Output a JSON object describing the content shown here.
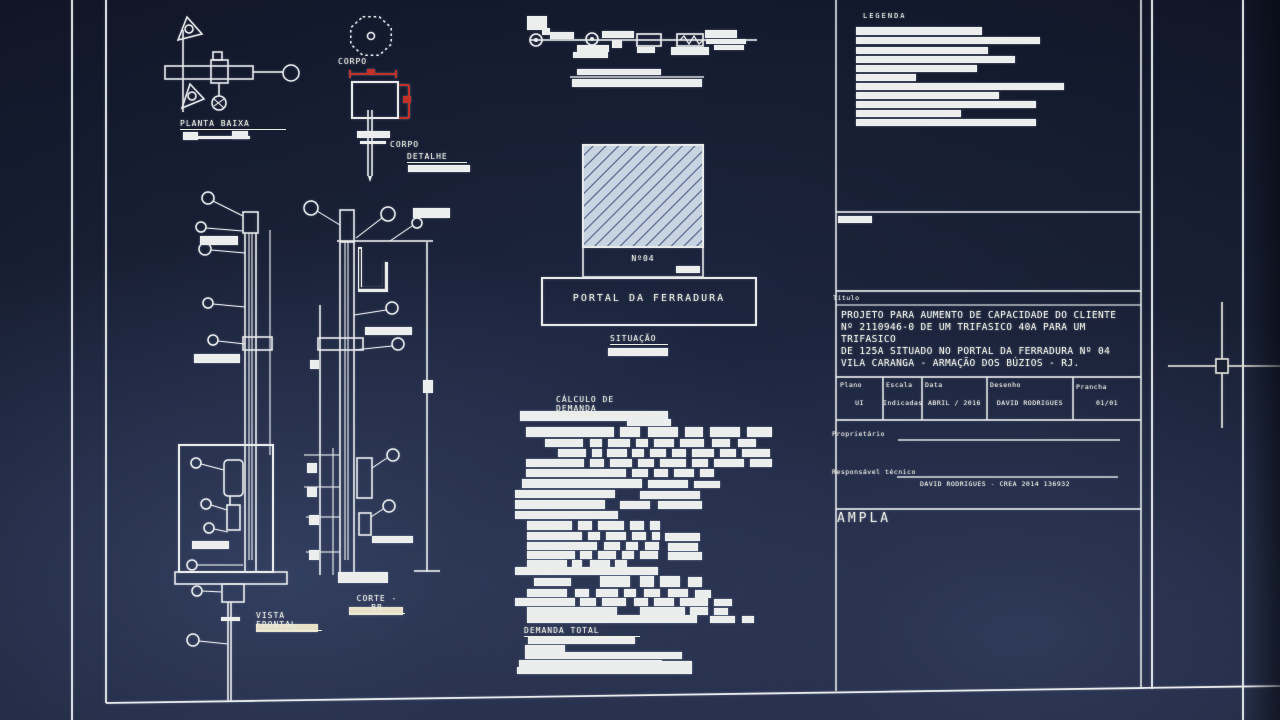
{
  "colors": {
    "line": "#e8eae9",
    "red_dimension": "#c23128",
    "sheet_background": "#161c2d",
    "hatch_fill": "#c9d4e2",
    "hatch_stripe": "#55658a",
    "label_bar_tan": "#e8e1c8"
  },
  "drawings": {
    "planta_baixa_label": "PLANTA BAIXA",
    "corpo_octagon_label": "CORPO",
    "corpo_detail_label": "CORPO",
    "detalhe_label": "DETALHE",
    "situacao_label": "SITUAÇÃO",
    "poste_numero": "Nº04",
    "portal_label": "PORTAL DA FERRADURA",
    "calculo_demanda_label": "CÁLCULO DE DEMANDA",
    "demanda_total_label": "DEMANDA TOTAL",
    "vista_frontal_label": "VISTA FRONTAL",
    "corte_bb_label": "CORTE - BB"
  },
  "title_block": {
    "legenda_label": "LEGENDA",
    "titulo_label": "Título",
    "titulo_text": "PROJETO PARA AUMENTO DE CAPACIDADE DO CLIENTE\nNº 2110946-0 DE UM TRIFASICO 40A PARA UM TRIFASICO\nDE 125A SITUADO NO PORTAL DA FERRADURA Nº 04\nVILA CARANGA - ARMAÇÃO DOS BÚZIOS - RJ.",
    "fields": [
      {
        "label": "Plano",
        "value": "UI"
      },
      {
        "label": "Escala",
        "value": "Indicadas"
      },
      {
        "label": "Data",
        "value": "ABRIL / 2016"
      },
      {
        "label": "Desenho",
        "value": "DAVID RODRIGUES"
      },
      {
        "label": "Prancha",
        "value": "01/01"
      }
    ],
    "proprietario_label": "Proprietário",
    "responsavel_label": "Responsável técnico",
    "responsavel_value": "DAVID RODRIGUES - CREA 2014 136932",
    "company": "AMPLA"
  },
  "redacted": {
    "legend": [
      [
        856,
        27,
        126,
        8
      ],
      [
        856,
        37,
        184,
        7
      ],
      [
        856,
        47,
        132,
        7
      ],
      [
        856,
        56,
        159,
        7
      ],
      [
        856,
        65,
        121,
        7
      ],
      [
        856,
        74,
        60,
        7
      ],
      [
        856,
        83,
        208,
        7
      ],
      [
        856,
        92,
        143,
        7
      ],
      [
        856,
        101,
        180,
        7
      ],
      [
        856,
        110,
        105,
        7
      ],
      [
        856,
        119,
        180,
        7
      ],
      [
        838,
        216,
        34,
        7
      ]
    ],
    "diagram_caption": [
      [
        577,
        69,
        84,
        6
      ],
      [
        572,
        79,
        130,
        8
      ]
    ],
    "demand_table": [
      [
        520,
        411,
        148,
        10
      ],
      [
        627,
        419,
        44,
        7
      ],
      [
        526,
        427,
        88,
        10
      ],
      [
        620,
        427,
        20,
        10
      ],
      [
        648,
        427,
        30,
        10
      ],
      [
        685,
        427,
        18,
        10
      ],
      [
        710,
        427,
        30,
        10
      ],
      [
        747,
        427,
        25,
        10
      ],
      [
        545,
        439,
        38,
        8
      ],
      [
        590,
        439,
        12,
        8
      ],
      [
        608,
        439,
        22,
        8
      ],
      [
        636,
        439,
        12,
        8
      ],
      [
        654,
        439,
        20,
        8
      ],
      [
        680,
        439,
        24,
        8
      ],
      [
        712,
        439,
        18,
        8
      ],
      [
        738,
        439,
        18,
        8
      ],
      [
        558,
        449,
        28,
        8
      ],
      [
        592,
        449,
        10,
        8
      ],
      [
        607,
        449,
        20,
        8
      ],
      [
        632,
        449,
        12,
        8
      ],
      [
        650,
        449,
        16,
        8
      ],
      [
        672,
        449,
        14,
        8
      ],
      [
        692,
        449,
        22,
        8
      ],
      [
        720,
        449,
        16,
        8
      ],
      [
        742,
        449,
        28,
        8
      ],
      [
        526,
        459,
        58,
        8
      ],
      [
        590,
        459,
        14,
        8
      ],
      [
        610,
        459,
        22,
        8
      ],
      [
        638,
        459,
        16,
        8
      ],
      [
        660,
        459,
        26,
        8
      ],
      [
        692,
        459,
        16,
        8
      ],
      [
        714,
        459,
        30,
        8
      ],
      [
        750,
        459,
        22,
        8
      ],
      [
        526,
        469,
        100,
        8
      ],
      [
        632,
        469,
        16,
        8
      ],
      [
        654,
        469,
        14,
        8
      ],
      [
        674,
        469,
        20,
        8
      ],
      [
        700,
        469,
        14,
        8
      ],
      [
        522,
        479,
        120,
        9
      ],
      [
        648,
        480,
        40,
        8
      ],
      [
        694,
        481,
        26,
        7
      ],
      [
        515,
        490,
        100,
        8
      ],
      [
        640,
        491,
        60,
        8
      ],
      [
        515,
        500,
        90,
        9
      ],
      [
        620,
        501,
        30,
        8
      ],
      [
        658,
        501,
        44,
        8
      ],
      [
        515,
        511,
        103,
        8
      ],
      [
        527,
        521,
        45,
        9
      ],
      [
        578,
        521,
        14,
        9
      ],
      [
        598,
        521,
        26,
        9
      ],
      [
        630,
        521,
        14,
        9
      ],
      [
        650,
        521,
        10,
        9
      ],
      [
        527,
        532,
        55,
        8
      ],
      [
        588,
        532,
        12,
        8
      ],
      [
        606,
        532,
        20,
        8
      ],
      [
        632,
        532,
        14,
        8
      ],
      [
        652,
        532,
        8,
        8
      ],
      [
        665,
        533,
        35,
        8
      ],
      [
        527,
        542,
        70,
        8
      ],
      [
        604,
        542,
        16,
        8
      ],
      [
        626,
        542,
        12,
        8
      ],
      [
        645,
        542,
        14,
        8
      ],
      [
        668,
        543,
        30,
        8
      ],
      [
        527,
        551,
        48,
        8
      ],
      [
        580,
        551,
        12,
        8
      ],
      [
        598,
        551,
        18,
        8
      ],
      [
        622,
        551,
        12,
        8
      ],
      [
        640,
        551,
        18,
        8
      ],
      [
        668,
        552,
        34,
        8
      ],
      [
        527,
        560,
        40,
        7
      ],
      [
        572,
        560,
        10,
        7
      ],
      [
        590,
        560,
        20,
        7
      ],
      [
        615,
        560,
        12,
        7
      ],
      [
        515,
        567,
        143,
        8
      ],
      [
        534,
        578,
        37,
        8
      ],
      [
        600,
        576,
        30,
        11
      ],
      [
        640,
        576,
        14,
        11
      ],
      [
        660,
        576,
        20,
        11
      ],
      [
        688,
        577,
        14,
        10
      ],
      [
        527,
        589,
        40,
        8
      ],
      [
        575,
        589,
        14,
        8
      ],
      [
        596,
        589,
        22,
        8
      ],
      [
        624,
        589,
        12,
        8
      ],
      [
        644,
        589,
        16,
        8
      ],
      [
        668,
        589,
        20,
        8
      ],
      [
        695,
        590,
        16,
        8
      ],
      [
        515,
        598,
        60,
        8
      ],
      [
        580,
        598,
        16,
        8
      ],
      [
        602,
        598,
        24,
        8
      ],
      [
        634,
        598,
        14,
        8
      ],
      [
        654,
        598,
        20,
        8
      ],
      [
        680,
        598,
        28,
        8
      ],
      [
        714,
        599,
        18,
        7
      ],
      [
        527,
        607,
        90,
        8
      ],
      [
        640,
        607,
        45,
        8
      ],
      [
        690,
        607,
        18,
        8
      ],
      [
        714,
        608,
        14,
        7
      ],
      [
        527,
        615,
        170,
        8
      ],
      [
        710,
        616,
        25,
        7
      ],
      [
        742,
        616,
        12,
        7
      ]
    ],
    "demand_total": [
      [
        528,
        637,
        107,
        7
      ],
      [
        525,
        645,
        40,
        7
      ],
      [
        525,
        652,
        157,
        7
      ],
      [
        519,
        660,
        143,
        7
      ],
      [
        662,
        661,
        30,
        6
      ],
      [
        517,
        667,
        175,
        7
      ]
    ],
    "vista_labels": [
      [
        200,
        236,
        38,
        9
      ],
      [
        194,
        354,
        46,
        9
      ]
    ],
    "corte_labels": [
      [
        413,
        208,
        37,
        10
      ],
      [
        365,
        327,
        47,
        8
      ],
      [
        372,
        536,
        41,
        7
      ]
    ],
    "planta_marks": [
      [
        183,
        132,
        15,
        8
      ],
      [
        232,
        131,
        16,
        8
      ],
      [
        198,
        136,
        52,
        3
      ]
    ],
    "detalhe_bar": [
      [
        408,
        165,
        62,
        7
      ]
    ],
    "situacao_bar": [
      [
        608,
        348,
        60,
        8
      ]
    ],
    "n04_bar": [
      [
        676,
        266,
        24,
        7
      ]
    ]
  },
  "redacted_tan": [
    [
      256,
      624,
      62,
      8
    ],
    [
      349,
      607,
      54,
      8
    ]
  ]
}
